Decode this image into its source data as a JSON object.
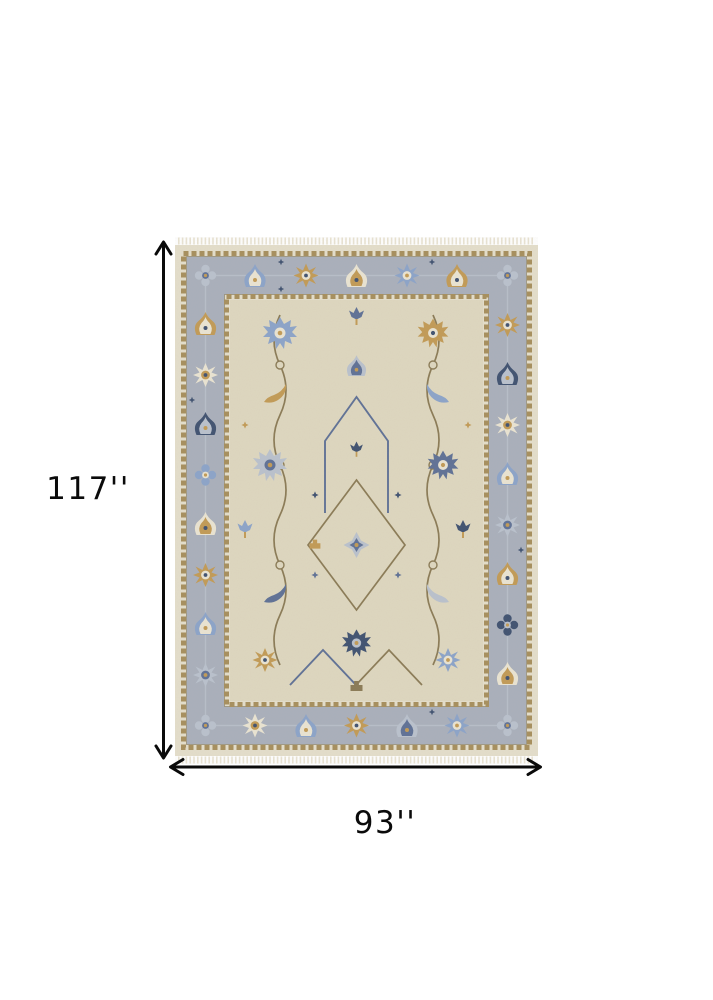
{
  "page": {
    "background": "#ffffff",
    "type": "product-dimension-image"
  },
  "rug": {
    "alt": "Hand-knotted oriental Oushak style area rug with beige field, gray-blue floral border and fringe",
    "style": "oushak-floral",
    "fringe": true
  },
  "dimensions": {
    "height_label": "117''",
    "width_label": "93''"
  },
  "icons": {
    "height_arrow": "double-headed-vertical-arrow",
    "width_arrow": "double-headed-horizontal-arrow"
  },
  "colors": {
    "annotation": "#0a0a0a",
    "rug_outer_band": "#e4decb",
    "rug_fringe": "#e9e3d2",
    "guard_stripe": "#a68e5c",
    "guard_edge": "#8f8468",
    "rug_border": "#a9afbb",
    "border_vine": "#b7bec9",
    "rug_field": "#ded7bf",
    "motif_blue": "#8ba3c9",
    "motif_slate": "#5e7095",
    "motif_navy": "#3f5170",
    "motif_gold": "#c29a55",
    "motif_brown": "#8a7a55",
    "motif_cream": "#eae4d2",
    "motif_gray_blue": "#b9c1cd"
  }
}
